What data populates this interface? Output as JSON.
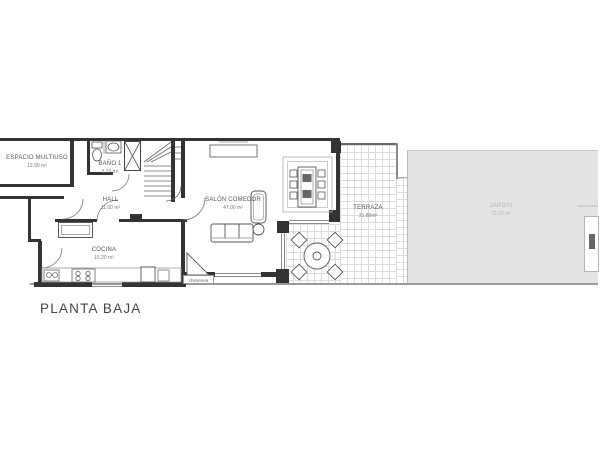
{
  "title": "PLANTA BAJA",
  "rooms": {
    "espacio_multiuso": {
      "name": "ESPACIO MULTIUSO",
      "area": "12.90 m²"
    },
    "bano1": {
      "name": "BAÑO 1",
      "area": "3.10 m²"
    },
    "hall": {
      "name": "HALL",
      "area": "11.00 m²"
    },
    "cocina": {
      "name": "COCINA",
      "area": "16.20 m²"
    },
    "salon_comedor": {
      "name": "SALÓN COMEDOR",
      "area": "47.00 m²"
    },
    "terraza": {
      "name": "TERRAZA",
      "area": "31.80m²"
    },
    "jardin": {
      "name": "JARDIN",
      "area": "72.00 m²"
    }
  },
  "annotations": {
    "chimenea": "chimenea"
  },
  "colors": {
    "wall": "#333333",
    "thin_line": "#8a8a8a",
    "tile_line": "#dcdcdc",
    "garden_fill": "#e4e4e4",
    "room_label": "#555555",
    "area_label": "#7a7a7a",
    "garden_label": "#b3b3b3",
    "title": "#454545"
  }
}
